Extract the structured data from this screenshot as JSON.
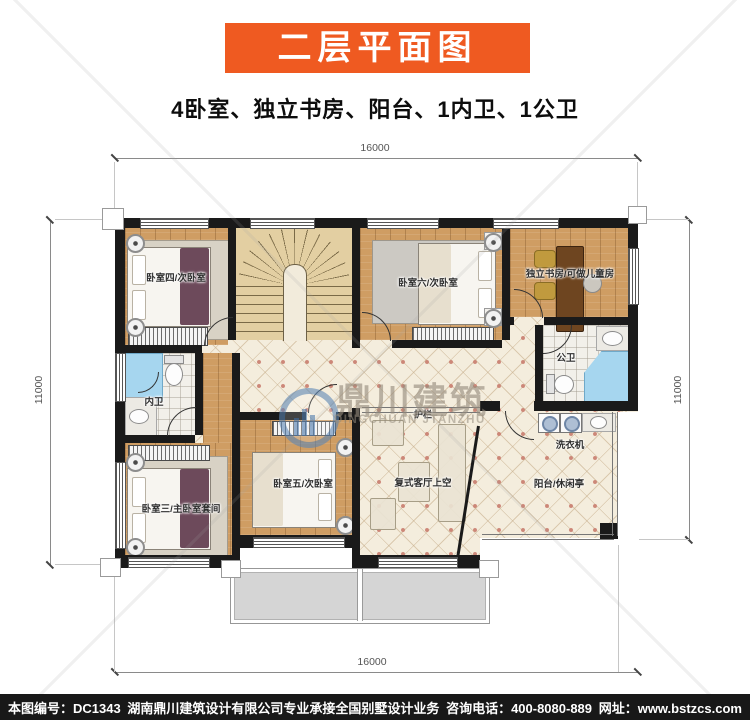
{
  "header": {
    "title": "二层平面图",
    "subtitle": "4卧室、独立书房、阳台、1内卫、1公卫"
  },
  "plan": {
    "rooms": {
      "bedroom4": "卧室四/次卧室",
      "bedroom6": "卧室六/次卧室",
      "study": "独立书房/可做儿童房",
      "public_bath": "公卫",
      "inner_bath": "内卫",
      "bedroom3": "卧室三/主卧室套间",
      "bedroom5": "卧室五/次卧室",
      "living_void": "复式客厅上空",
      "balcony": "阳台/休闲亭",
      "washer": "洗衣机",
      "railing": "护栏"
    },
    "dimensions": {
      "top": "16000",
      "bottom": "16000",
      "left": "11000",
      "right": "11000"
    }
  },
  "watermark": {
    "zh": "鼎川建筑",
    "en": "DINGCHUAN JTANZHU"
  },
  "footer": {
    "plan_no": "本图编号：DC1343",
    "company": "湖南鼎川建筑设计有限公司专业承接全国别墅设计业务",
    "phone": "咨询电话：400-8080-889",
    "website": "网址：www.bstzcs.com"
  },
  "colors": {
    "accent": "#EF5A21",
    "wall": "#1A1A1A",
    "wood_floor": "#CF9D63",
    "hall_tile": "#F4EDDD",
    "bath_blue": "#A6D6EF",
    "stair_tan": "#E3CFA2",
    "footer_bg": "#181818"
  }
}
